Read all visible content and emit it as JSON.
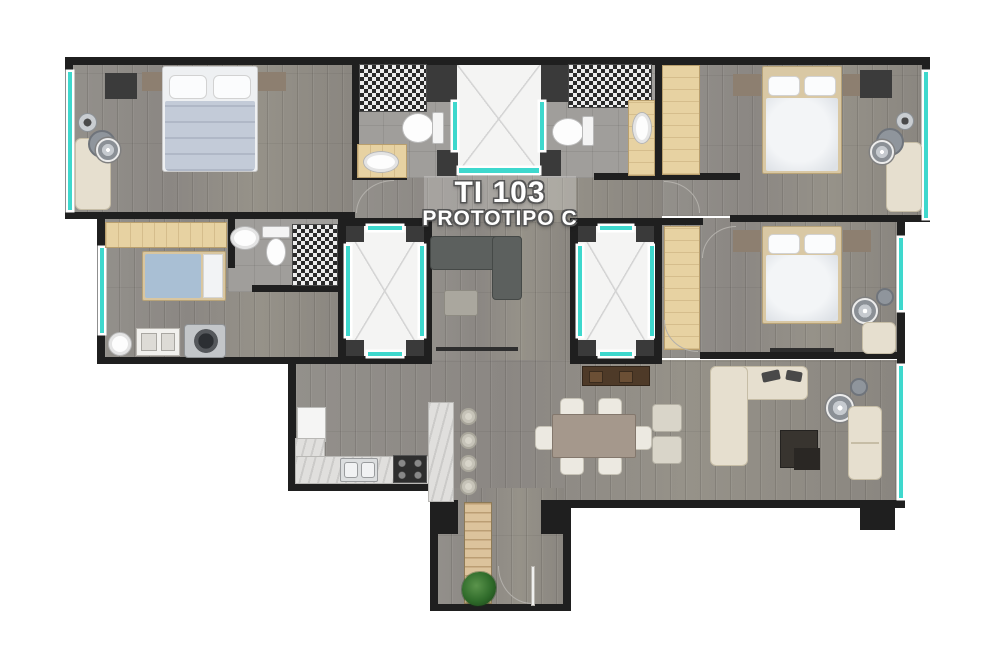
{
  "plan": {
    "unit_label": "TI 103",
    "prototype_label": "PROTOTIPO C"
  },
  "colors": {
    "background": "#ffffff",
    "wall": "#1f1f1f",
    "window-teal": "#3ed8cd",
    "wood-floor": "#8f8b86",
    "tile-floor": "#a09e9b",
    "closet-wood": "#e7d2a2",
    "counter-marble": "#e0dfdd",
    "accent-cream": "#e6dfcf",
    "accent-dark-sofa": "#5c605e",
    "dining-table": "#a5988c",
    "stairs-wood": "#dcc39c",
    "plant-green": "#2f6b2a",
    "duvet-blue": "#c3cbd8",
    "bed-white": "#eceff3"
  }
}
